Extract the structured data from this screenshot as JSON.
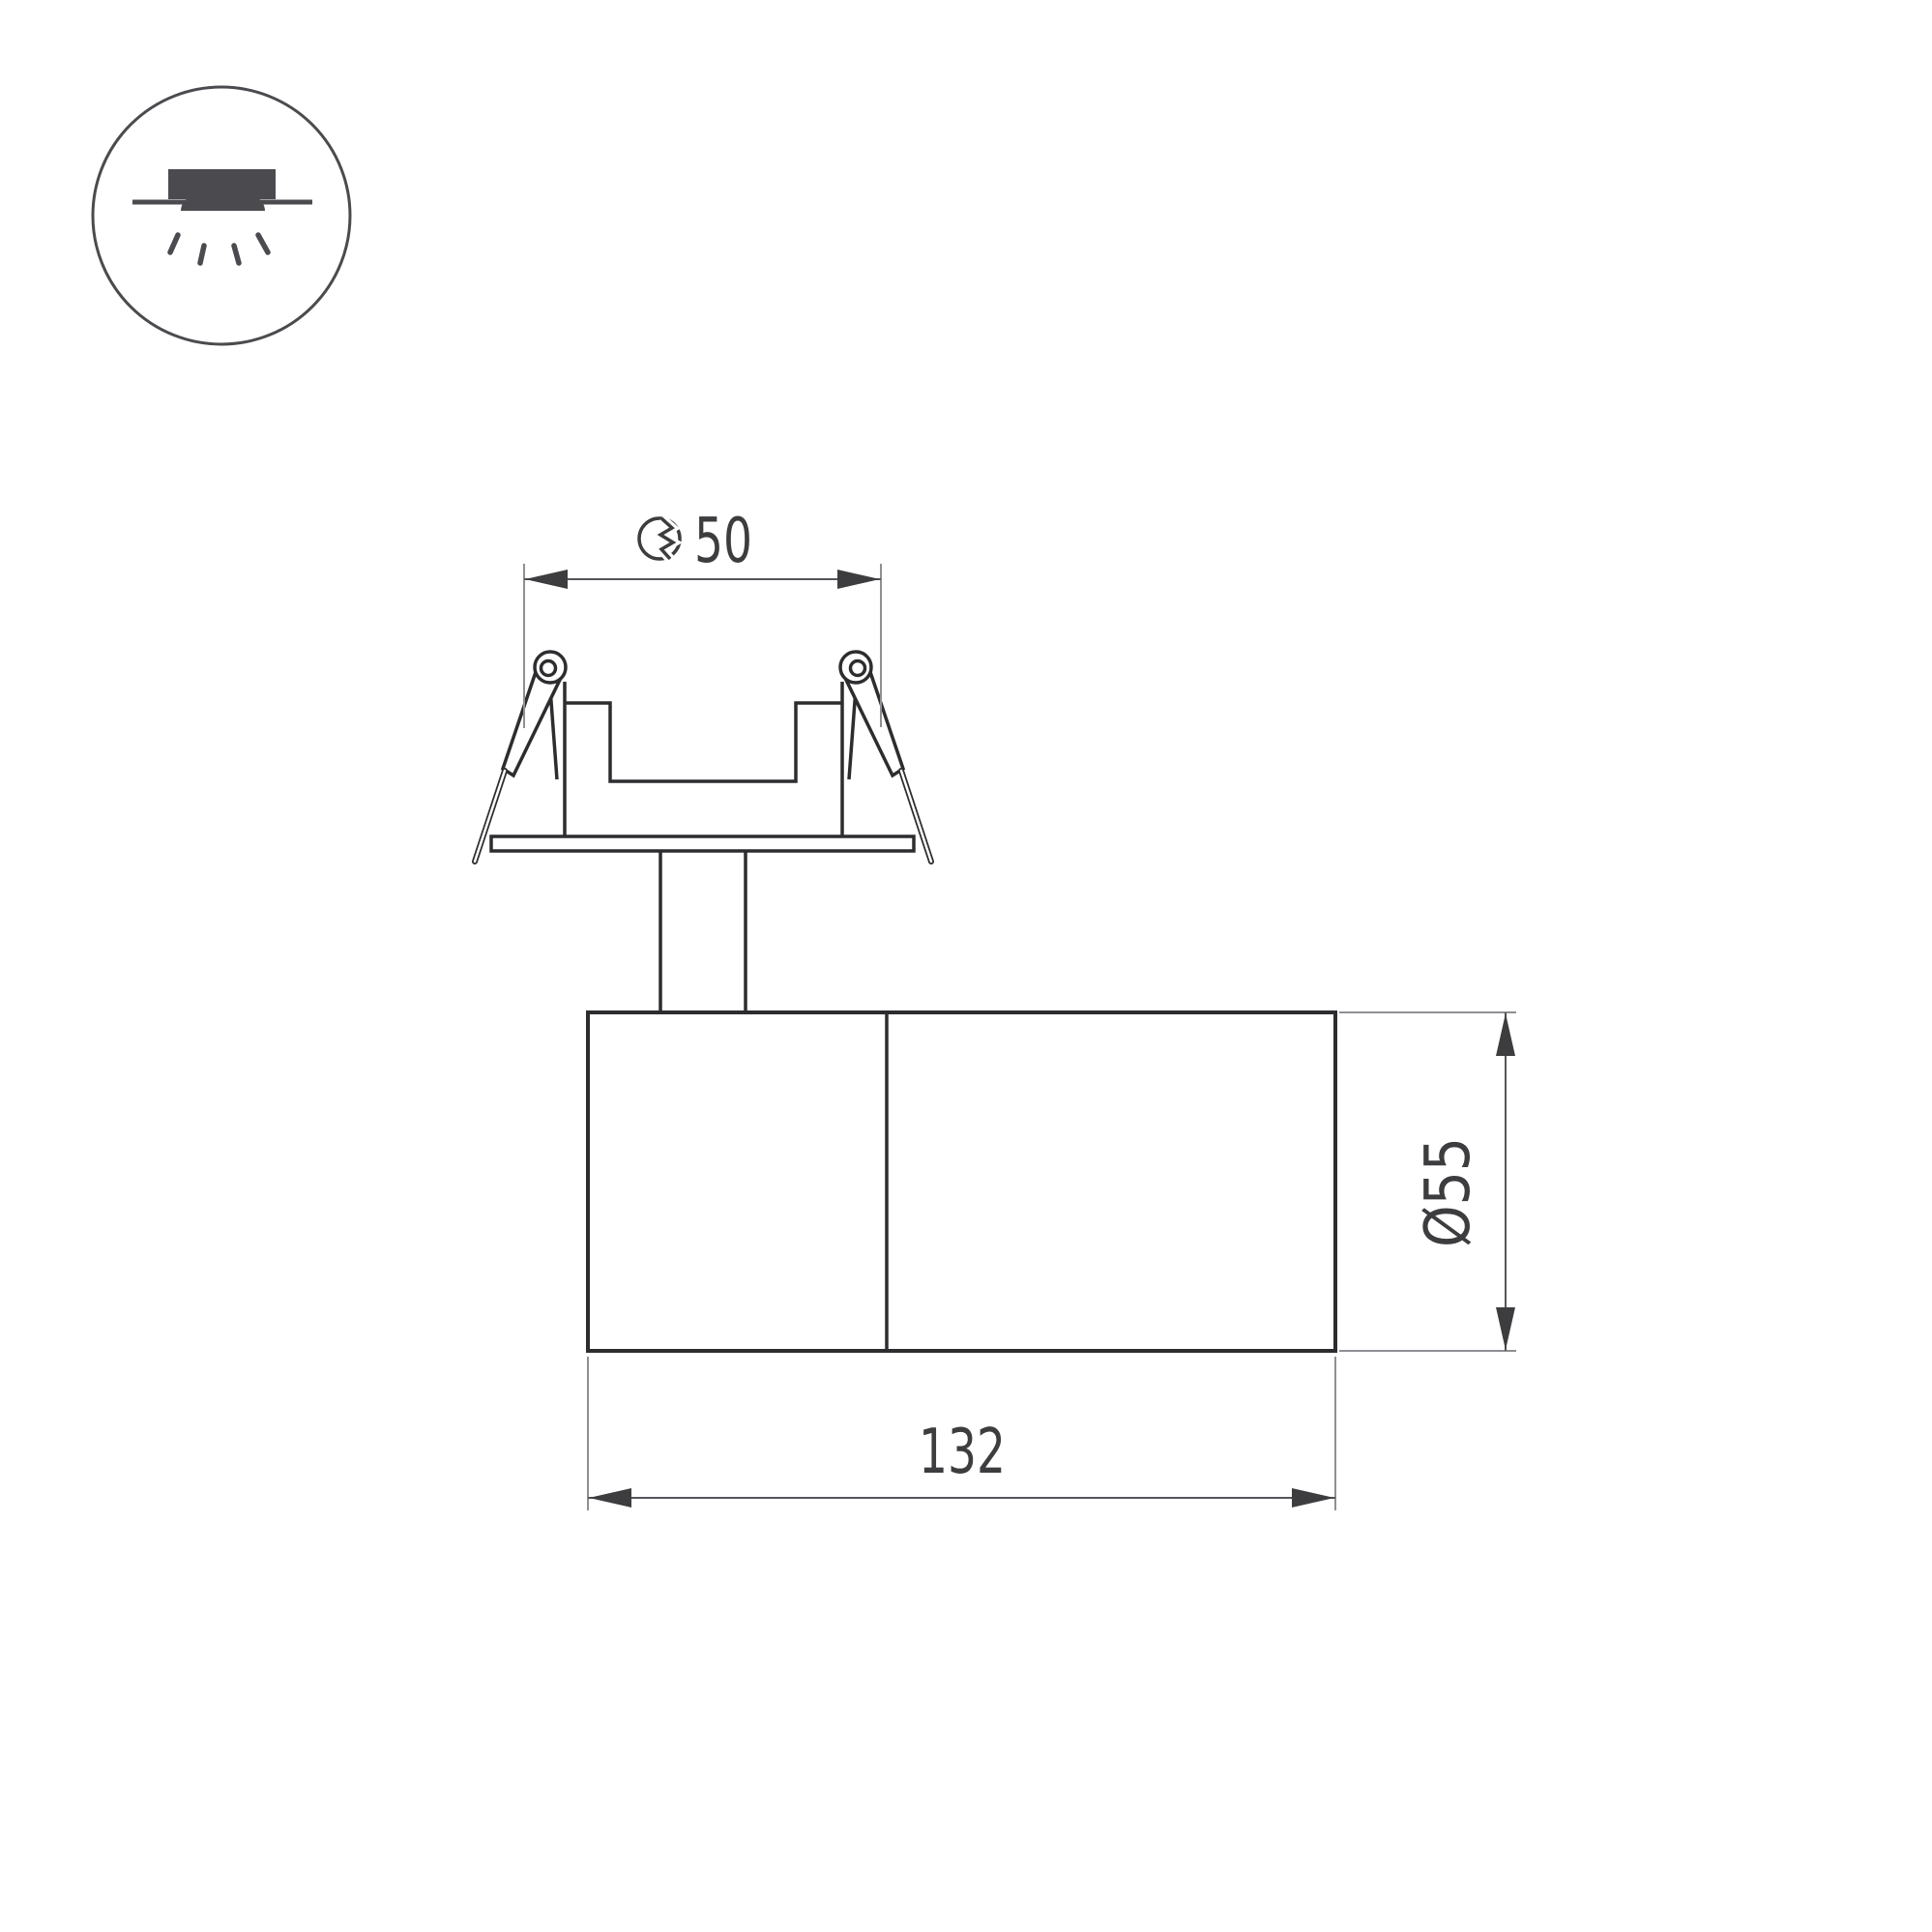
{
  "colors": {
    "background": "#ffffff",
    "outline": "#2d2d30",
    "icon": "#4b4b4f",
    "extension_line": "#909094",
    "dimension_line": "#55555a",
    "dimension_text": "#3d3d40"
  },
  "badge": {
    "icon": "recessed-downlight-icon",
    "description": "recessed ceiling downlight pictogram"
  },
  "drawing": {
    "type": "luminaire-dimension-drawing",
    "dimensions": {
      "cutout": {
        "icon": "cutout-hole-icon",
        "value": "50"
      },
      "body_diameter": {
        "label": "Ø55"
      },
      "body_length": {
        "label": "132"
      }
    }
  }
}
